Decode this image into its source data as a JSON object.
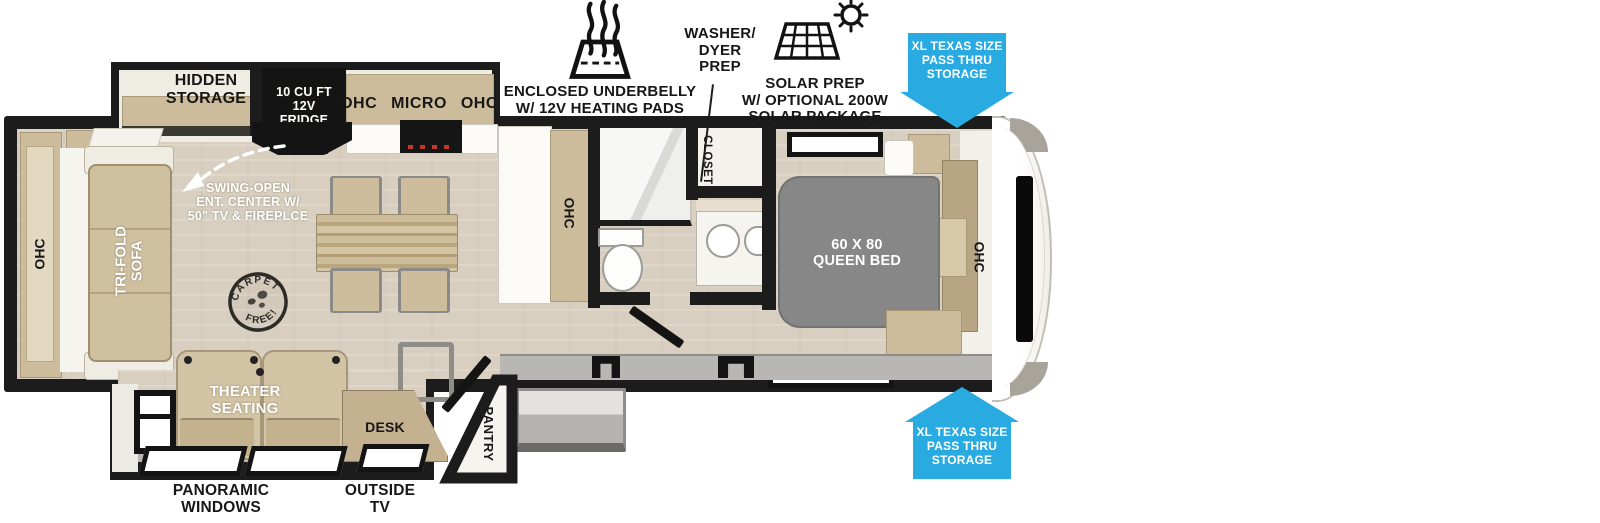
{
  "accent_blue": "#29abe2",
  "callouts": {
    "underbelly": "ENCLOSED UNDERBELLY\nW/ 12V HEATING PADS",
    "washer_dryer": "WASHER/\nDYER\nPREP",
    "solar": "SOLAR PREP\nW/ OPTIONAL 200W\nSOLAR PACKAGE",
    "pass_thru_top": "XL TEXAS SIZE\nPASS THRU\nSTORAGE",
    "pass_thru_bottom": "XL TEXAS SIZE\nPASS THRU\nSTORAGE",
    "panoramic_windows": "PANORAMIC\nWINDOWS",
    "outside_tv": "OUTSIDE\nTV",
    "swing_open": "SWING-OPEN\nENT. CENTER W/\n50\" TV & FIREPLCE"
  },
  "labels": {
    "hidden_storage": "HIDDEN\nSTORAGE",
    "fridge": "10 CU FT\n12V\nFRIDGE",
    "kitchen_ohc": "OHC MICRO OHC",
    "galley_ohc": "OHC",
    "sofa_ohc": "OHC",
    "tri_fold_sofa": "TRI-FOLD\nSOFA",
    "closet": "CLOSET",
    "queen_bed": "60 X 80\nQUEEN BED",
    "bed_ohc": "OHC",
    "theater_seating": "THEATER\nSEATING",
    "desk": "DESK",
    "pantry": "PANTRY",
    "carpet_free_top": "CARPET",
    "carpet_free_bottom": "FREE!"
  }
}
